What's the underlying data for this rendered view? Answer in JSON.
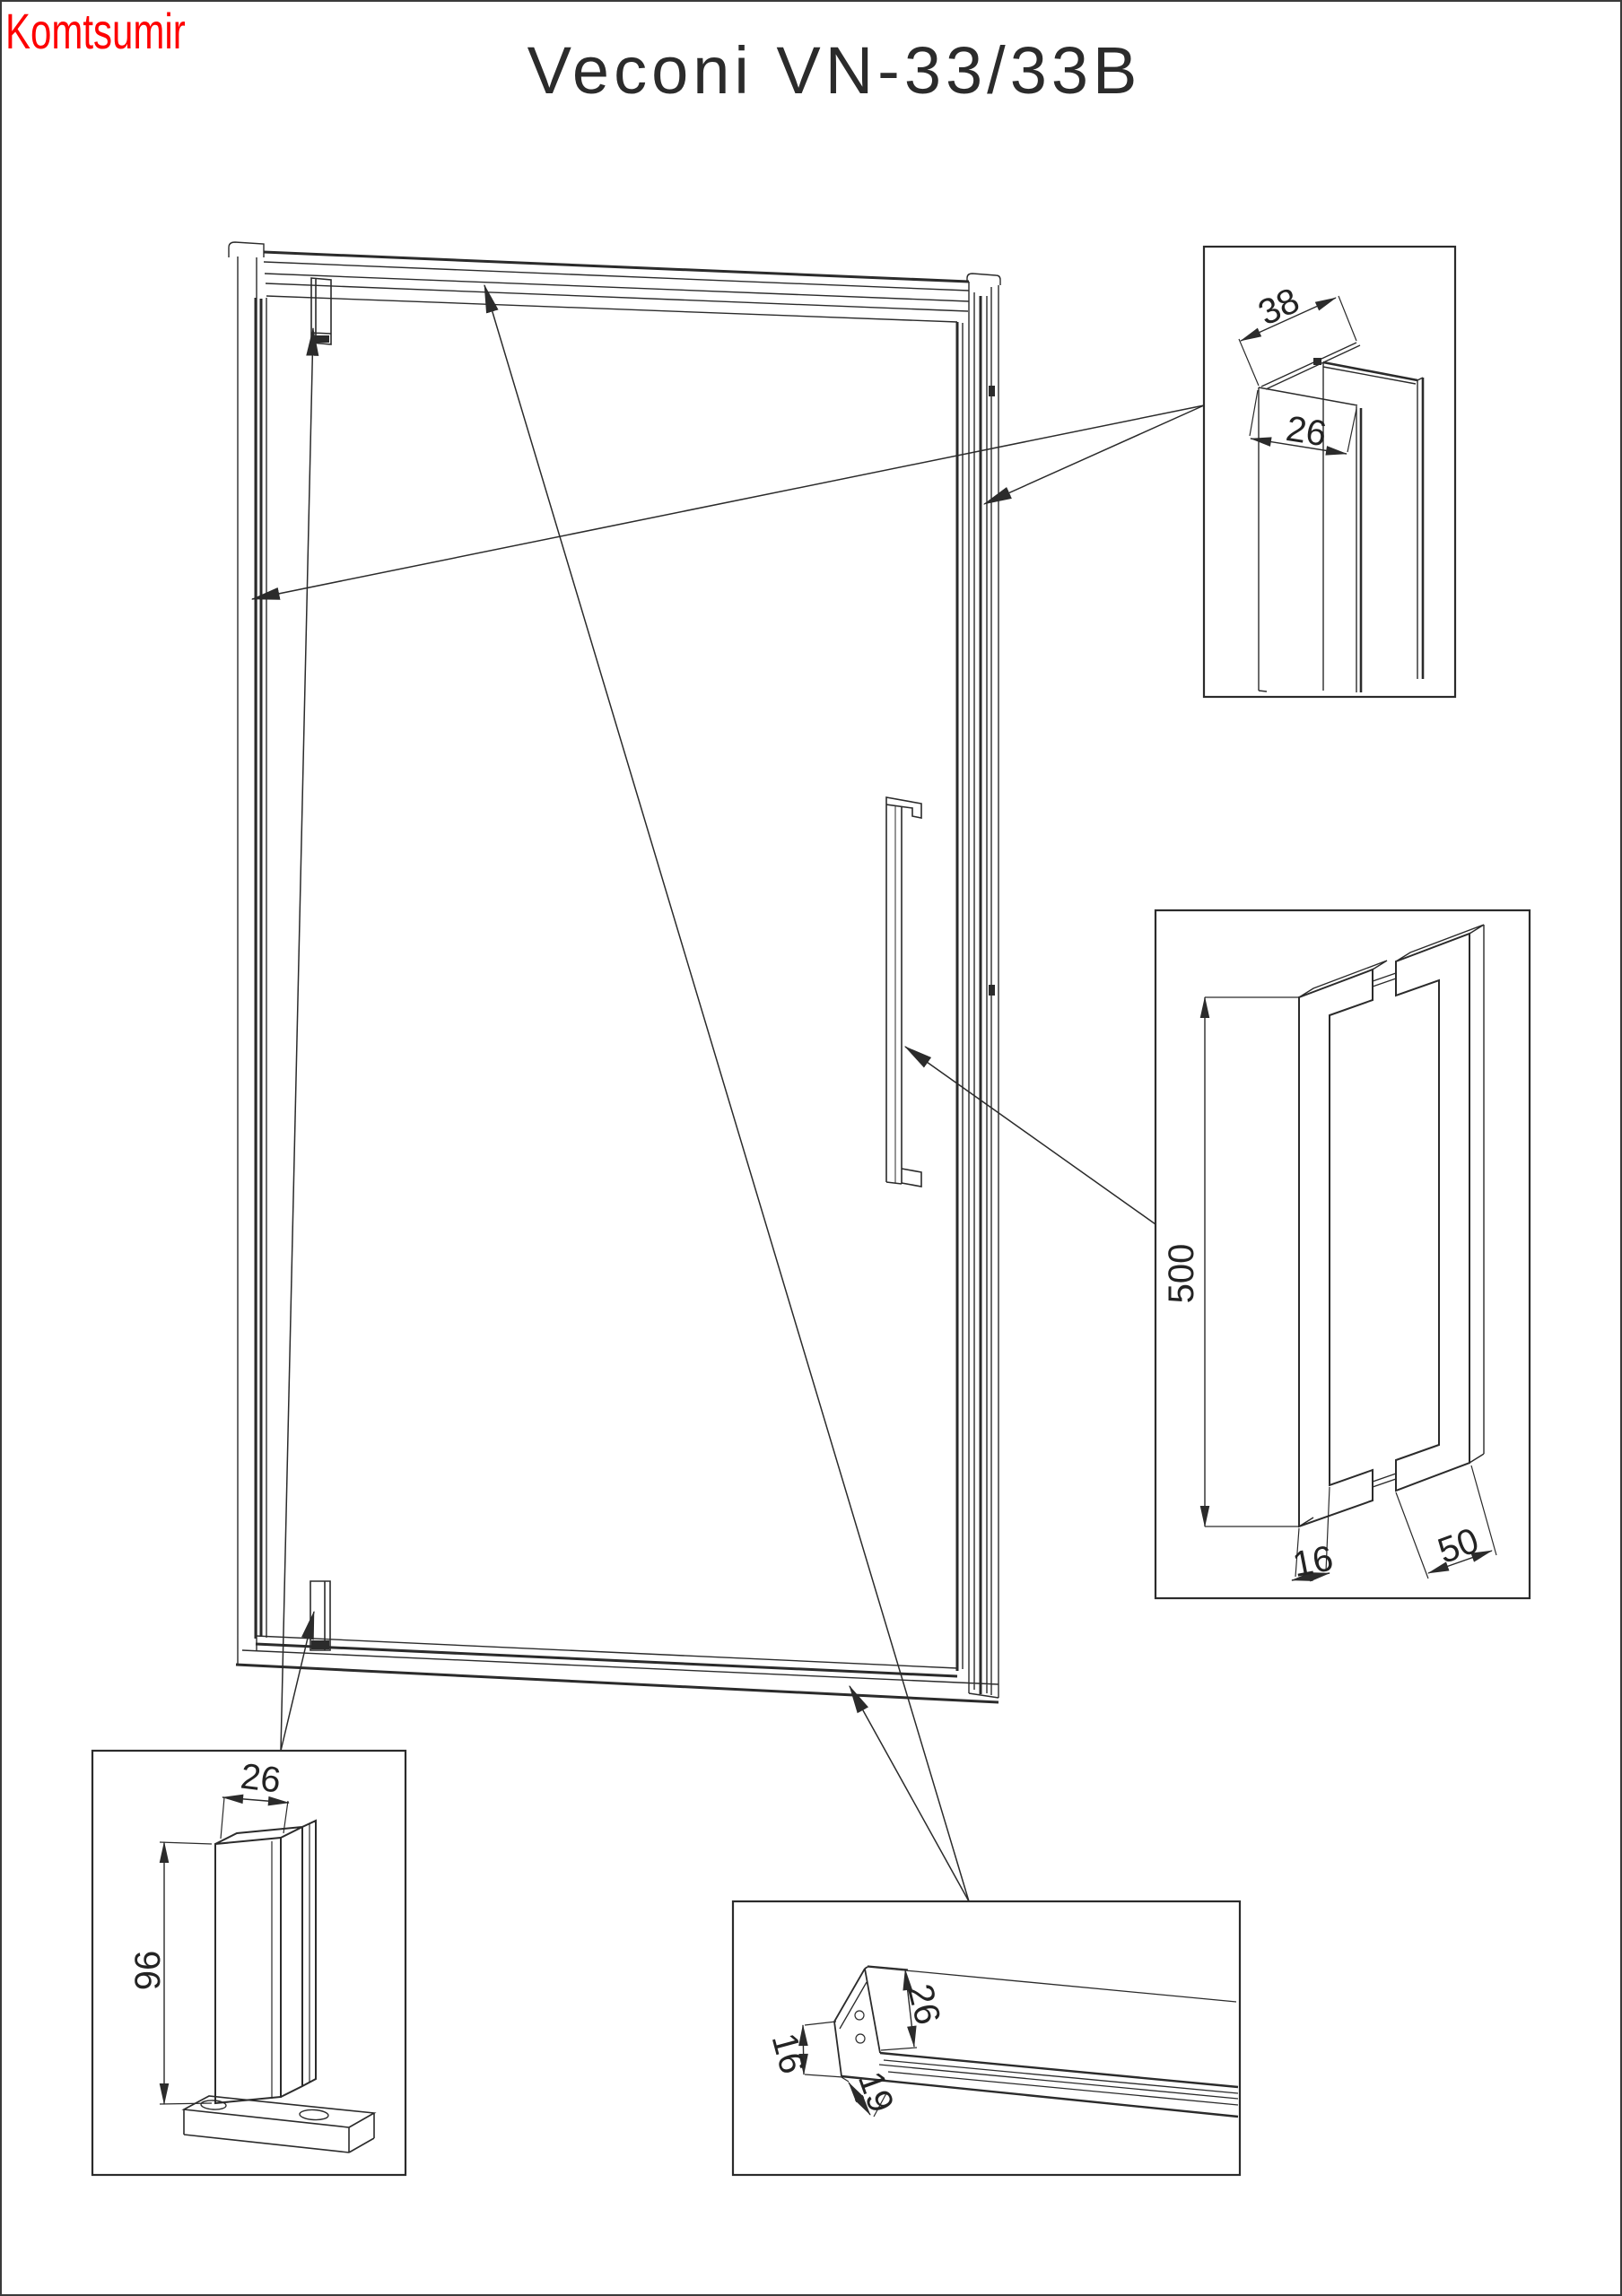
{
  "page": {
    "watermark": "Komtsumir",
    "title": "Veconi VN-33/33B"
  },
  "colors": {
    "watermark_red": "#fe0000",
    "line_color": "#2b2b2b",
    "background": "#ffffff"
  },
  "dimensions": {
    "wall_profile": {
      "width": "38",
      "flange": "26"
    },
    "handle": {
      "length": "500",
      "bar": "16",
      "depth": "50"
    },
    "pivot_clamp": {
      "width": "26",
      "height": "96"
    },
    "bottom_rail": {
      "upstand": "26",
      "side": "16",
      "base": "19"
    }
  }
}
